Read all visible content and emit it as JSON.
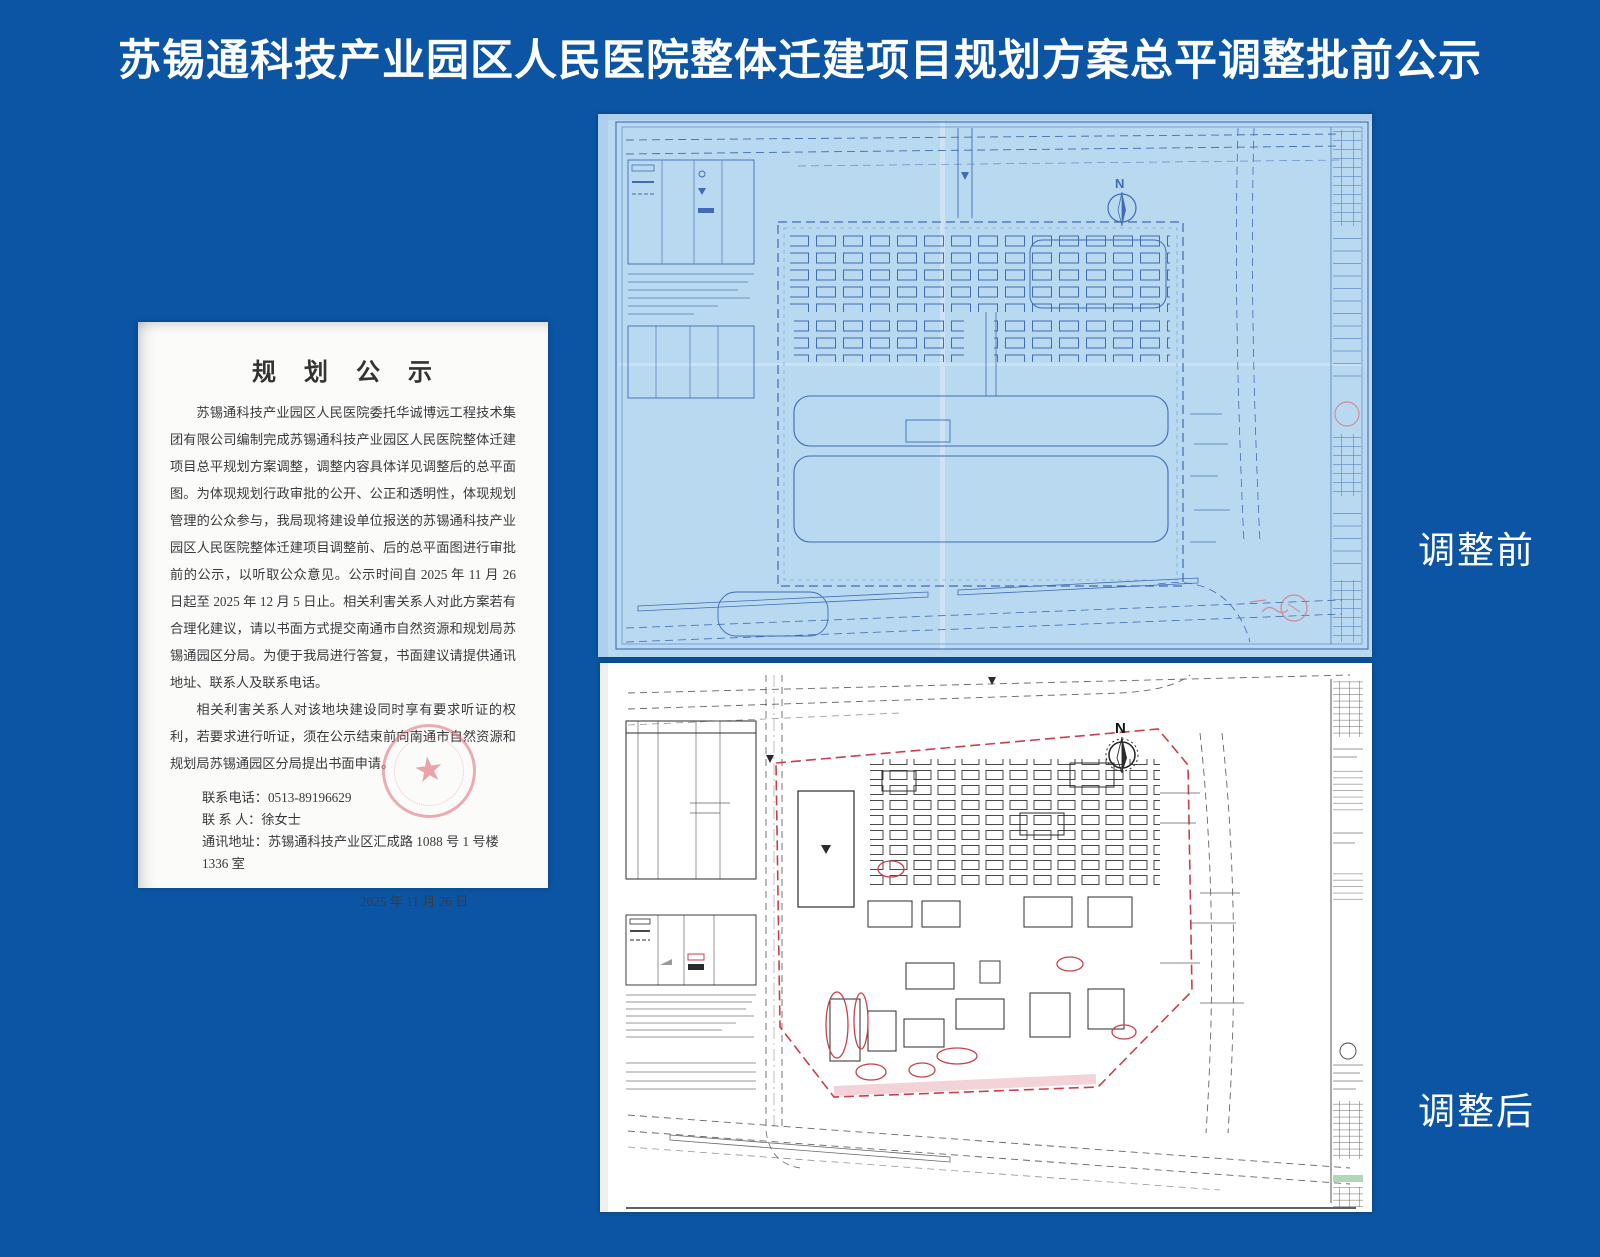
{
  "page": {
    "title": "苏锡通科技产业园区人民医院整体迁建项目规划方案总平调整批前公示",
    "background_color": "#0b55a4",
    "title_color": "#ffffff"
  },
  "notice_document": {
    "heading": "规　划　公　示",
    "paragraphs": [
      "苏锡通科技产业园区人民医院委托华诚博远工程技术集团有限公司编制完成苏锡通科技产业园区人民医院整体迁建项目总平规划方案调整，调整内容具体详见调整后的总平面图。为体现规划行政审批的公开、公正和透明性，体现规划管理的公众参与，我局现将建设单位报送的苏锡通科技产业园区人民医院整体迁建项目调整前、后的总平面图进行审批前的公示，以听取公众意见。公示时间自 2025 年 11 月 26 日起至 2025 年 12 月 5 日止。相关利害关系人对此方案若有合理化建议，请以书面方式提交南通市自然资源和规划局苏锡通园区分局。为便于我局进行答复，书面建议请提供通讯地址、联系人及联系电话。",
      "相关利害关系人对该地块建设同时享有要求听证的权利，若要求进行听证，须在公示结束前向南通市自然资源和规划局苏锡通园区分局提出书面申请。"
    ],
    "contact": {
      "phone_label": "联系电话：",
      "phone": "0513-89196629",
      "person_label": "联 系 人：",
      "person": "徐女士",
      "address_label": "通讯地址：",
      "address": "苏锡通科技产业区汇成路 1088 号 1 号楼 1336 室"
    },
    "date": "2025 年 11 月 26 日",
    "seal": {
      "star": "★",
      "color": "#e06a78"
    }
  },
  "plans": {
    "before": {
      "label": "调整前",
      "compass_label": "N",
      "paper_color": "#b9d9f1",
      "ink_color": "#3f6cb4"
    },
    "after": {
      "label": "调整后",
      "compass_label": "N",
      "paper_color": "#ffffff",
      "ink_color": "#2b2b2b",
      "boundary_color": "#c9404a"
    }
  }
}
